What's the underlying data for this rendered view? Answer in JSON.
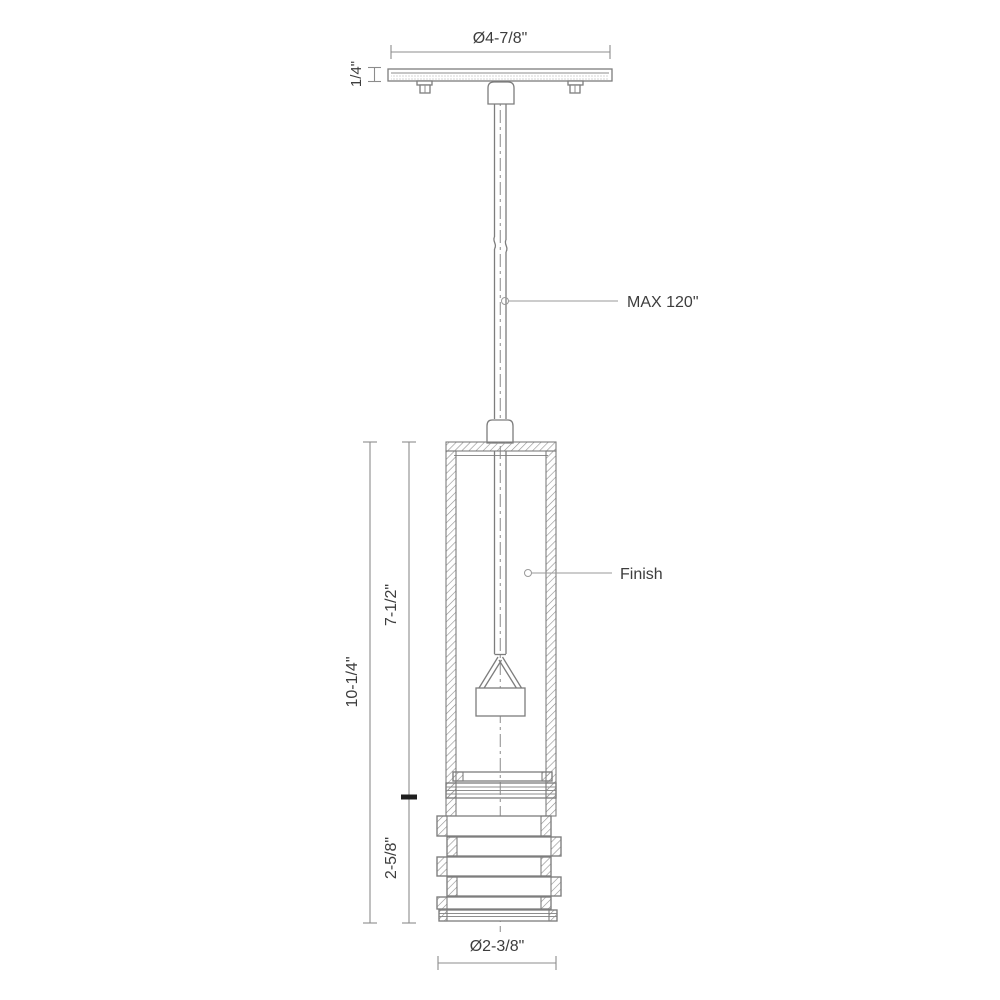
{
  "drawing": {
    "type": "pendant-light-fixture-dimension-diagram",
    "labels": {
      "canopy_diameter": "Ø4-7/8\"",
      "canopy_thickness": "1/4\"",
      "max_drop": "MAX 120\"",
      "finish": "Finish",
      "overall_height": "10-1/4\"",
      "upper_height": "7-1/2\"",
      "lower_height": "2-5/8\"",
      "body_diameter": "Ø2-3/8\""
    },
    "colors": {
      "background": "#ffffff",
      "object_line": "#7d7d7d",
      "dimension_line": "#8c8c8c",
      "text": "#3d3d3d",
      "junction_tick": "#1f1f1f"
    }
  }
}
